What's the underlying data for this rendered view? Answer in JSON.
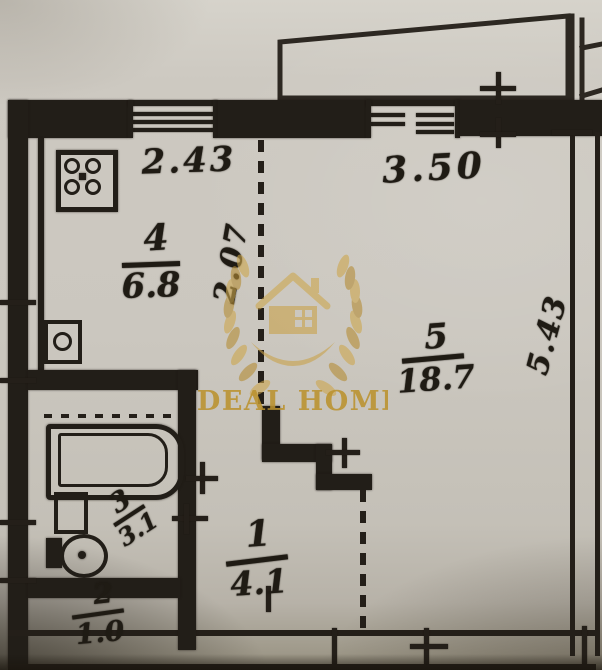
{
  "watermark": {
    "brand": "IDEAL HOME"
  },
  "plan": {
    "dims": {
      "kitchen_width": "2.43",
      "kitchen_depth": "2.07",
      "living_width": "3.50",
      "living_depth": "5.43"
    },
    "rooms": {
      "hall": {
        "number": "1",
        "area": "4.1"
      },
      "wc": {
        "number": "2",
        "area": "1.0"
      },
      "bath": {
        "number": "3",
        "area": "3.1"
      },
      "kitchen": {
        "number": "4",
        "area": "6.8"
      },
      "living": {
        "number": "5",
        "area": "18.7"
      }
    }
  },
  "colors": {
    "ink": "#221e18",
    "paper": "#cbc7bf",
    "gold": "#c49b3f"
  }
}
